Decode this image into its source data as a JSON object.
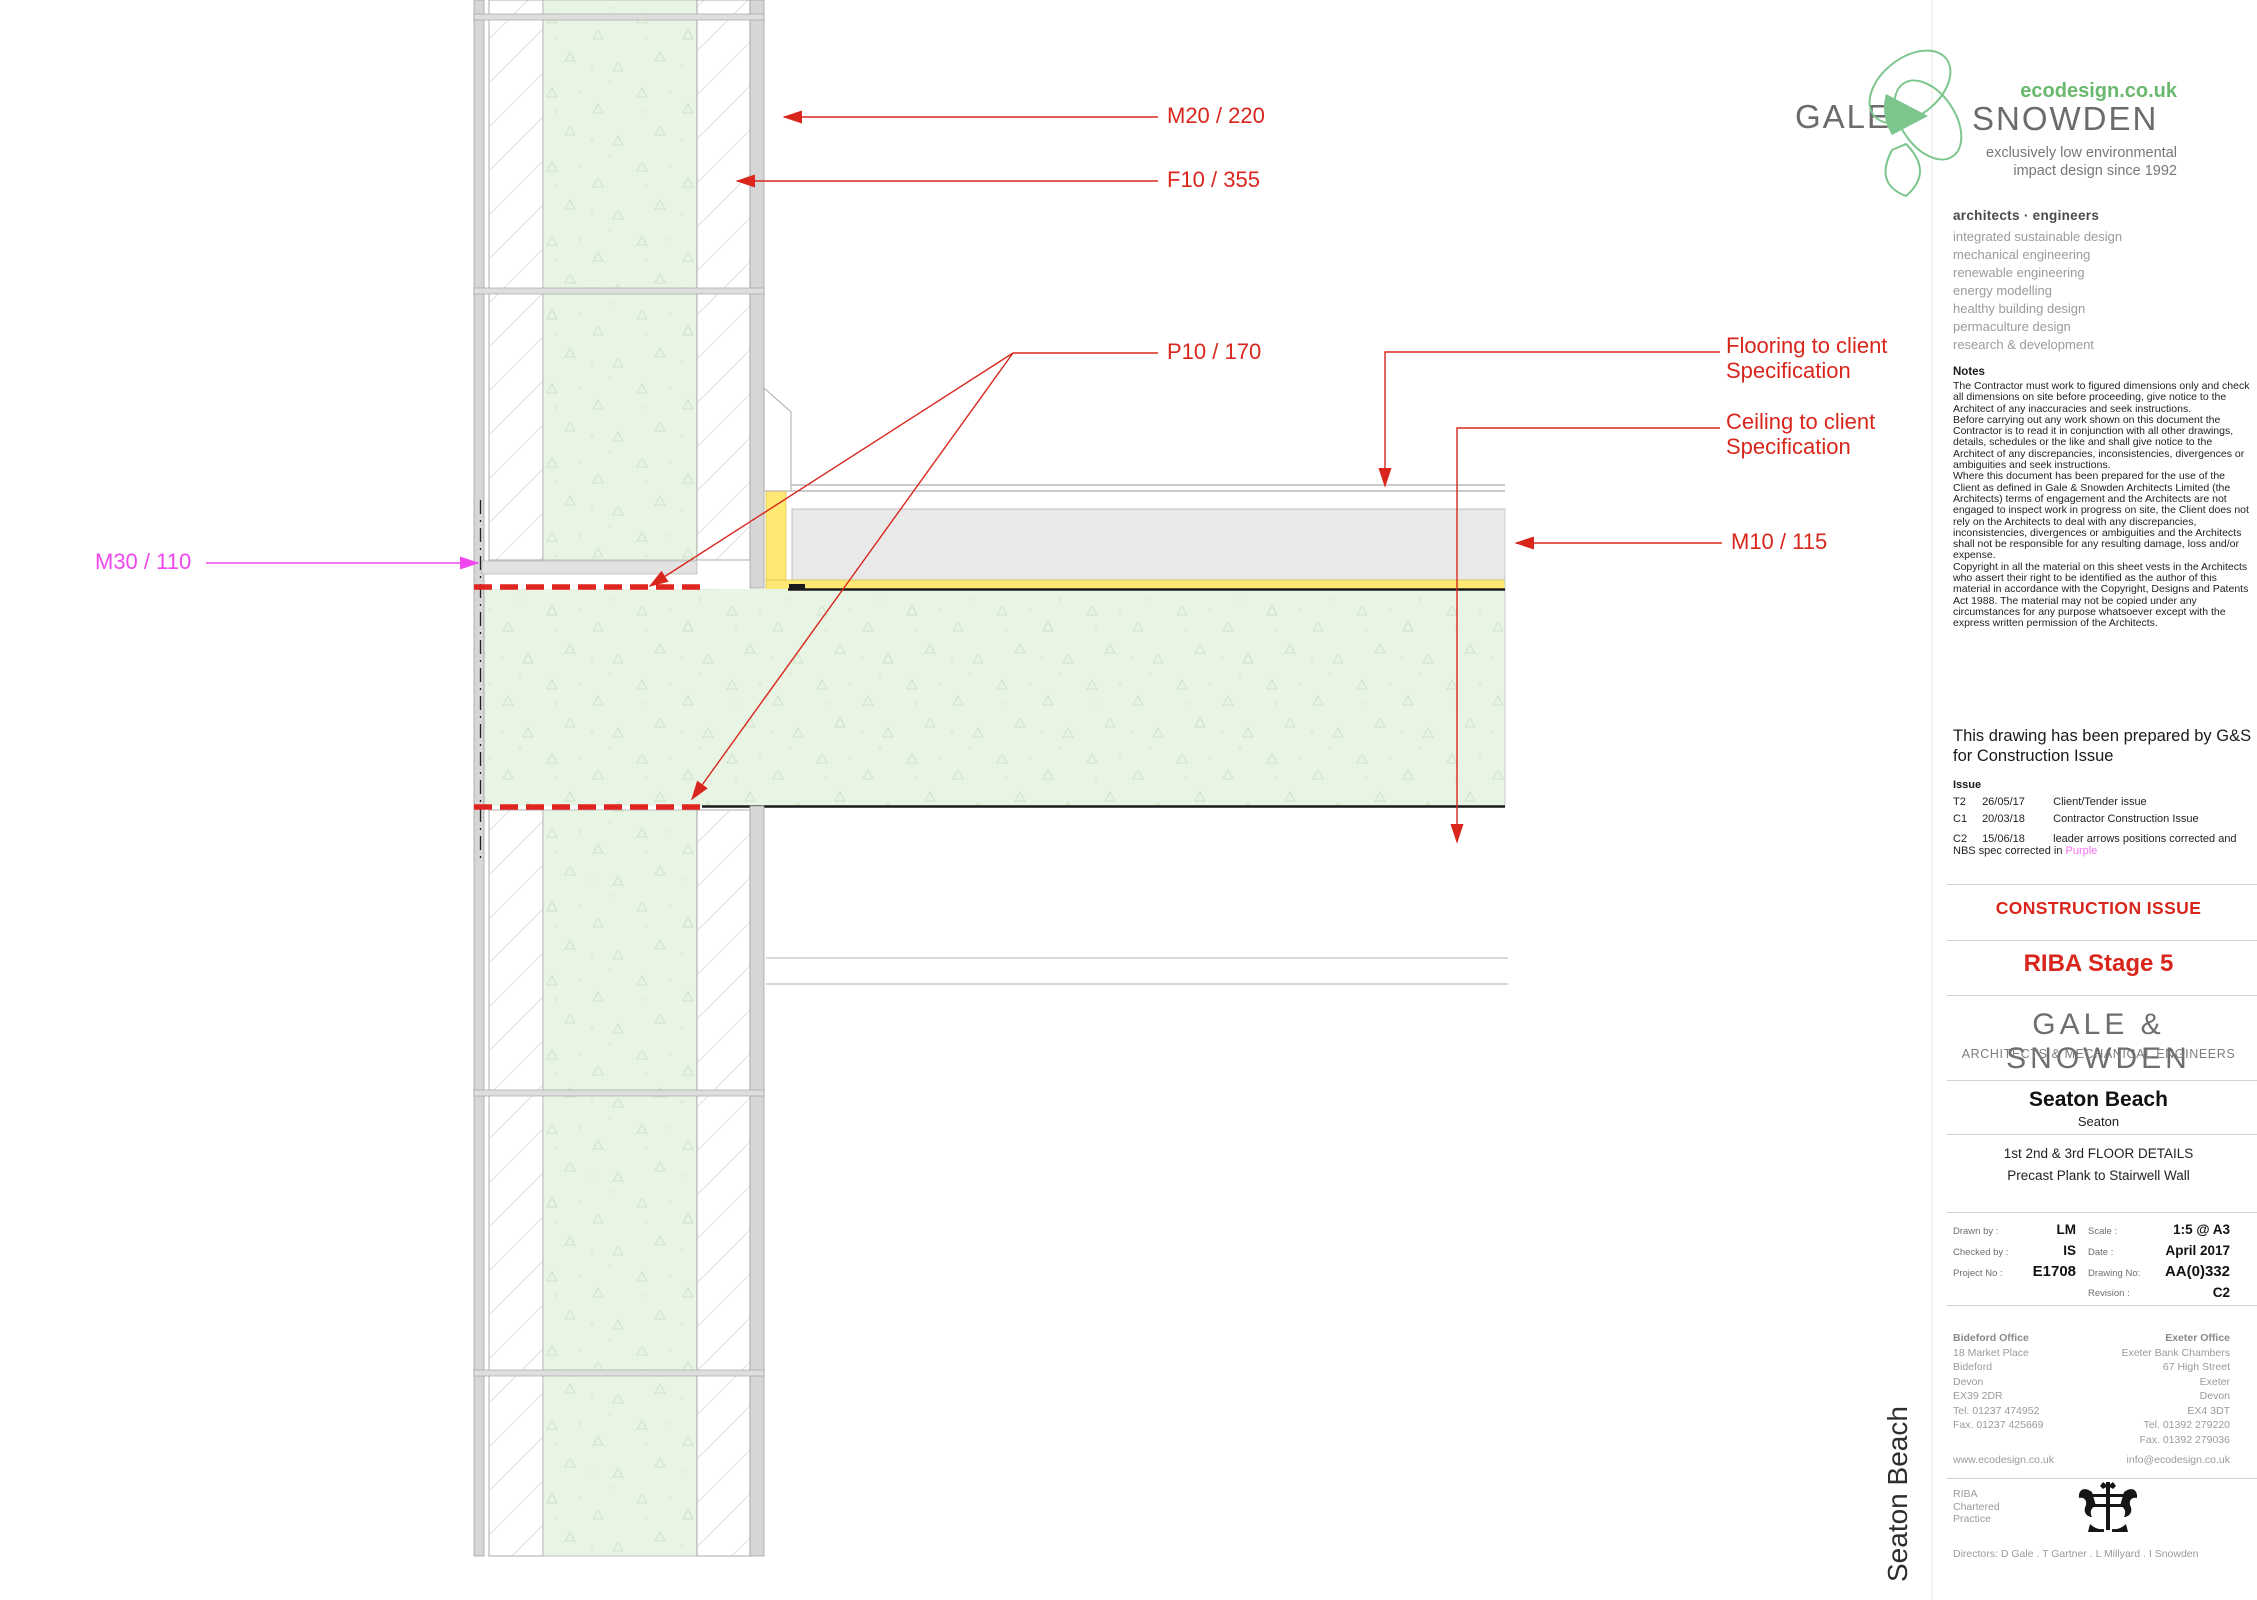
{
  "logo": {
    "gale": "GALE",
    "snowden": "SNOWDEN",
    "ecodesign": "ecodesign.co.uk",
    "tagline1": "exclusively low environmental",
    "tagline2": "impact design since 1992"
  },
  "services": {
    "heading": "architects  ·  engineers",
    "items": [
      "integrated sustainable design",
      "mechanical engineering",
      "renewable engineering",
      "energy modelling",
      "healthy building design",
      "permaculture design",
      "research & development"
    ]
  },
  "notes": {
    "heading": "Notes",
    "p1": "The Contractor must work to figured dimensions only and check all dimensions on site before proceeding, give notice to the Architect of any inaccuracies and seek instructions.",
    "p2": "Before carrying out any work shown on this document the Contractor is to read it in conjunction with all other drawings, details, schedules or the like and shall give notice to the Architect of any discrepancies, inconsistencies, divergences or ambiguities and seek instructions.",
    "p3": "Where this document has been prepared for the use of the Client as defined in Gale & Snowden Architects Limited (the Architects) terms of engagement and the Architects are not engaged to inspect work in progress on site, the Client does not rely on the Architects to deal with any discrepancies, inconsistencies, divergences or ambiguities and the Architects shall not be responsible for any resulting damage, loss and/or expense.",
    "p4": "Copyright in all the material on this sheet vests in the Architects who assert their right to be identified as the author of this material in accordance with the Copyright, Designs and Patents Act 1988. The material may not be copied under any circumstances for any purpose whatsoever except with the express written permission of the Architects."
  },
  "prepared": {
    "text": "This drawing has been prepared by G&S for Construction Issue"
  },
  "issue": {
    "heading": "Issue",
    "rows": [
      {
        "code": "T2",
        "date": "26/05/17",
        "desc": "Client/Tender issue"
      },
      {
        "code": "C1",
        "date": "20/03/18",
        "desc": "Contractor Construction Issue"
      },
      {
        "code": "C2",
        "date": "15/06/18",
        "desc": "leader arrows positions corrected and"
      }
    ],
    "row3_line2_prefix": "NBS spec corrected in ",
    "row3_line2_highlight": "Purple"
  },
  "stamps": {
    "construction_issue": "CONSTRUCTION ISSUE",
    "riba_stage": "RIBA Stage 5"
  },
  "practice": {
    "name": "GALE  &  SNOWDEN",
    "subtitle": "ARCHITECTS & MECHANICAL ENGINEERS"
  },
  "project": {
    "name": "Seaton Beach",
    "location": "Seaton",
    "title1": "1st 2nd & 3rd FLOOR DETAILS",
    "title2": "Precast Plank to Stairwell Wall"
  },
  "info": {
    "drawn_by_label": "Drawn by :",
    "drawn_by": "LM",
    "checked_by_label": "Checked by :",
    "checked_by": "IS",
    "project_no_label": "Project No :",
    "project_no": "E1708",
    "scale_label": "Scale :",
    "scale": "1:5 @ A3",
    "date_label": "Date :",
    "date": "April 2017",
    "drawing_no_label": "Drawing No:",
    "drawing_no": "AA(0)332",
    "revision_label": "Revision :",
    "revision": "C2"
  },
  "offices": {
    "bideford": {
      "name": "Bideford Office",
      "lines": [
        "18 Market Place",
        "Bideford",
        "Devon",
        "EX39 2DR",
        "Tel. 01237 474952",
        "Fax. 01237 425669"
      ],
      "web": "www.ecodesign.co.uk"
    },
    "exeter": {
      "name": "Exeter Office",
      "lines": [
        "Exeter Bank Chambers",
        "67 High Street",
        "Exeter",
        "Devon",
        "EX4 3DT",
        "Tel. 01392 279220",
        "Fax. 01392 279036"
      ],
      "email": "info@ecodesign.co.uk"
    }
  },
  "riba": {
    "lines": [
      "RIBA",
      "Chartered",
      "Practice"
    ]
  },
  "directors": {
    "text": "Directors: D Gale . T Gartner . L Millyard . I Snowden"
  },
  "annotations": {
    "m20": "M20 / 220",
    "f10": "F10 / 355",
    "p10": "P10 / 170",
    "m10": "M10 / 115",
    "m30": "M30 / 110",
    "flooring_l1": "Flooring to client",
    "flooring_l2": "Specification",
    "ceiling_l1": "Ceiling to client",
    "ceiling_l2": "Specification"
  },
  "side_label": {
    "text": "Seaton Beach"
  },
  "colors": {
    "annotation_red": "#d9261c",
    "annotation_magenta": "#f046ee",
    "slab_green": "#e8f4e4",
    "screed_grey": "#e9e9e9",
    "membrane_yellow": "#ffe873",
    "logo_green": "#69b86e"
  }
}
